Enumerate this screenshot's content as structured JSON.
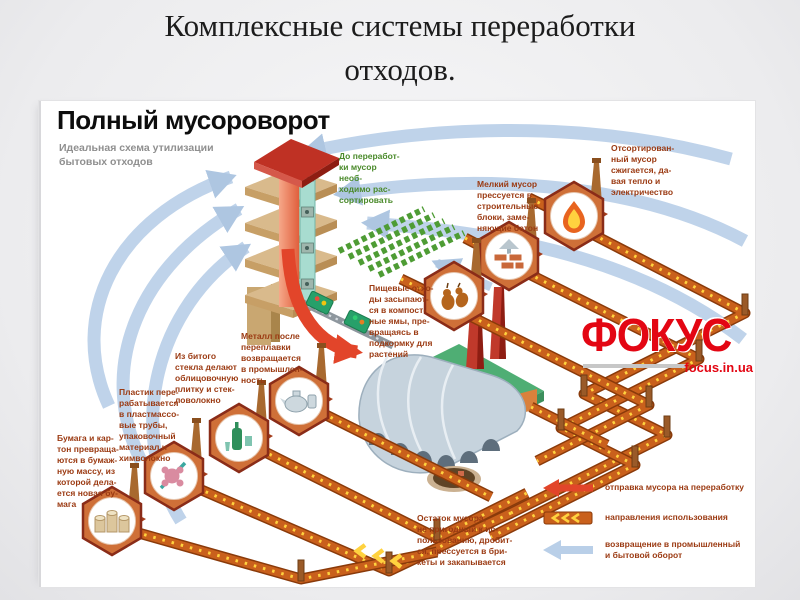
{
  "slide": {
    "title": "Комплексные системы переработки\nотходов."
  },
  "infographic": {
    "title": "Полный мусороворот",
    "subtitle": "Идеальная схема утилизации\nбытовых отходов",
    "labels": {
      "sort": "До переработ-\nки мусор необ-\nходимо рас-\nсортировать",
      "burn": "Отсортирован-\nный мусор\nсжигается, да-\nвая тепло и\nэлектричество",
      "small": "Мелкий мусор\nпрессуется в\nстроительные\nблоки, заме-\nняющие бетон",
      "food": "Пищевые отхо-\nды засыпают-\nся в компост-\nные ямы, пре-\nвращаясь в\nподкормку для\nрастений",
      "metal": "Металл после\nпереплавки\nвозвращается\nв промышлен-\nность",
      "glass": "Из битого\nстекла делают\nоблицовочную\nплитку и стек-\nловолокно",
      "plastic": "Пластик пере-\nрабатывается\nв пластмассо-\nвые трубы,\nупаковочный\nматериал и\nхимволокно",
      "paper": "Бумага и кар-\nтон превраща-\nются в бумаж-\nную массу, из\nкоторой дела-\nется новая бу-\nмага",
      "residue": "Остаток мусора,\nне пригодный к ис-\nпользованию, дробит-\nся, прессуется в бри-\nкеты и закапывается"
    },
    "legend": {
      "send": {
        "icon": "red-arrow-left",
        "text": "отправка мусора на переработку"
      },
      "use": {
        "icon": "conveyor-strip",
        "text": "направления использования"
      },
      "return": {
        "icon": "blue-arrow-left",
        "text": "возвращение в промышленный\nи бытовой оборот"
      }
    },
    "logo": {
      "name": "ФОКУС",
      "site": "focus.in.ua"
    },
    "colors": {
      "conveyor": "#c9601c",
      "chevron": "#ffd23f",
      "send_arrow": "#e2452a",
      "return_arrow": "#bcd1e9",
      "label_text": "#9b3a12",
      "logo_red": "#e30613"
    }
  }
}
